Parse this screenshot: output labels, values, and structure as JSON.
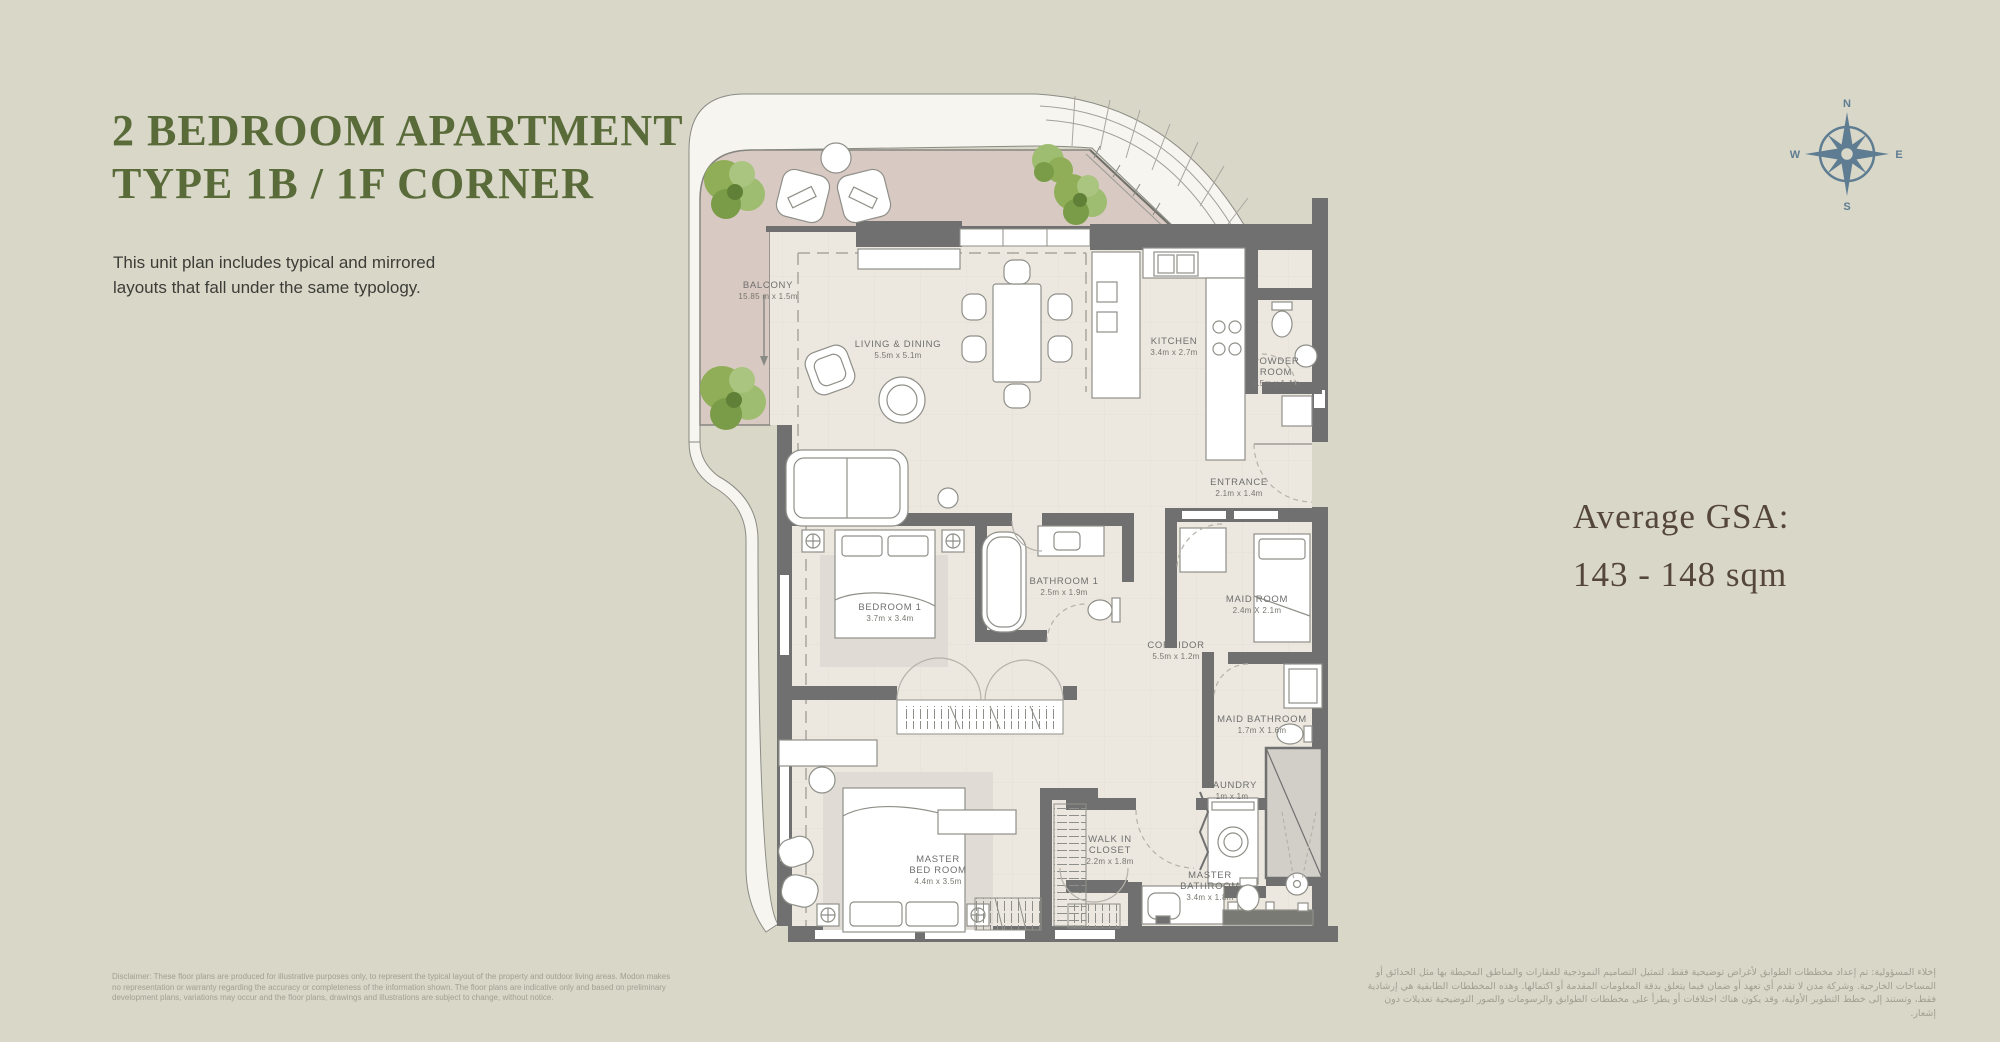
{
  "page": {
    "title_line1": "2 BEDROOM APARTMENT",
    "title_line2": "TYPE 1B / 1F CORNER",
    "description": "This unit plan includes typical and mirrored\nlayouts that fall under the same typology.",
    "gsa_label": "Average GSA:",
    "gsa_value": "143 - 148 sqm"
  },
  "compass": {
    "north": "N",
    "east": "E",
    "south": "S",
    "west": "W"
  },
  "rooms": [
    {
      "name": "BALCONY",
      "dims": "15.85 m x 1.5m"
    },
    {
      "name": "LIVING & DINING",
      "dims": "5.5m x 5.1m"
    },
    {
      "name": "KITCHEN",
      "dims": "3.4m x 2.7m"
    },
    {
      "name": "POWDER\nROOM",
      "dims": "1.5m x 1.4m"
    },
    {
      "name": "ENTRANCE",
      "dims": "2.1m x 1.4m"
    },
    {
      "name": "BEDROOM 1",
      "dims": "3.7m x 3.4m"
    },
    {
      "name": "BATHROOM 1",
      "dims": "2.5m x 1.9m"
    },
    {
      "name": "CORRIDOR",
      "dims": "5.5m x 1.2m"
    },
    {
      "name": "MAID ROOM",
      "dims": "2.4m X 2.1m"
    },
    {
      "name": "MAID BATHROOM",
      "dims": "1.7m X 1.6m"
    },
    {
      "name": "LAUNDRY",
      "dims": "1m x 1m"
    },
    {
      "name": "WALK IN\nCLOSET",
      "dims": "2.2m x 1.8m"
    },
    {
      "name": "MASTER\nBED ROOM",
      "dims": "4.4m x 3.5m"
    },
    {
      "name": "MASTER\nBATHROOM",
      "dims": "3.4m x 1.8m"
    }
  ],
  "disclaimers": {
    "english": "Disclaimer: These floor plans are produced for illustrative purposes only, to represent the typical layout of the property and outdoor living areas.  Modon makes\nno representation or warranty regarding the accuracy or completeness of the information shown.  The floor plans are indicative only and based on preliminary\ndevelopment plans, variations may occur and the floor plans, drawings and illustrations are subject to change, without notice.",
    "arabic": "إخلاء المسؤولية: تم إعداد مخططات الطوابق لأغراض توضيحية فقط، لتمثيل التصاميم النموذجية للعقارات والمناطق المحيطة بها مثل الحدائق أو\nالمساحات الخارجية. وشركة مدن لا تقدم أي تعهد أو ضمان فيما يتعلق بدقة المعلومات المقدمة أو اكتمالها. وهذه المخططات الطابقية هي إرشادية\nفقط، وتستند إلى خطط التطوير الأولية، وقد يكون هناك اختلافات أو يطرأ على مخططات الطوابق والرسومات والصور التوضيحية تعديلات دون إشعار."
  },
  "colors": {
    "background": "#d8d7c8",
    "title_green": "#5a6b3a",
    "gsa_brown": "#55463a",
    "compass_blue": "#5f7d92",
    "balcony_floor": "#d8c9c2",
    "interior_floor": "#ece7df",
    "wall_gray": "#707070",
    "tree_green": "#8fae57"
  }
}
